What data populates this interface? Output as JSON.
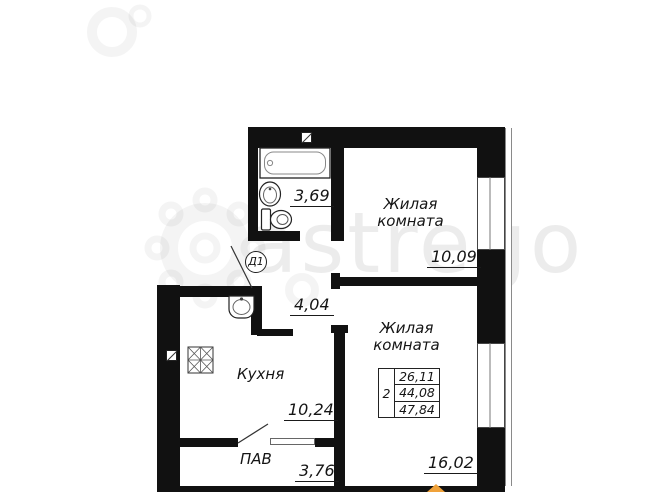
{
  "plan": {
    "watermark_text": "astrego",
    "door_label": "Д1",
    "rooms": {
      "bathroom": {
        "area": "3,69"
      },
      "living_top": {
        "name": "Жилая комната",
        "area": "10,09"
      },
      "hallway": {
        "area": "4,04"
      },
      "kitchen": {
        "name": "Кухня",
        "area": "10,24"
      },
      "pantry": {
        "name": "ПАВ",
        "area": "3,76"
      },
      "living_bottom": {
        "name": "Жилая комната",
        "area": "16,02"
      }
    },
    "stamp": {
      "rooms_count": "2",
      "values": [
        "26,11",
        "44,08",
        "47,84"
      ]
    },
    "colors": {
      "wall": "#111111",
      "marker": "#f0a23a"
    }
  }
}
